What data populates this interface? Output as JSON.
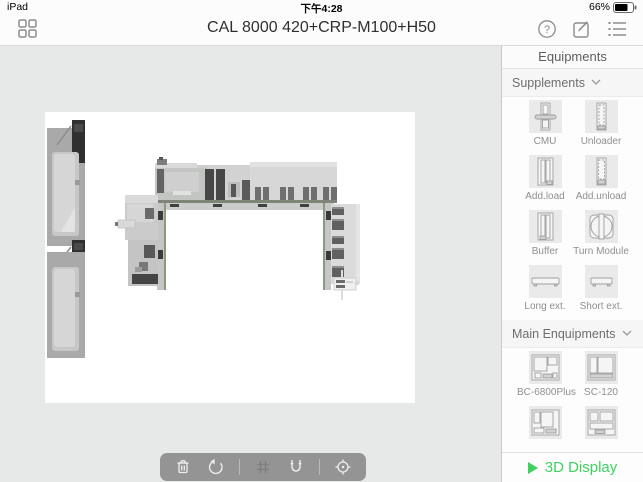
{
  "status_bar": {
    "device": "iPad",
    "time": "下午4:28",
    "battery": "66%"
  },
  "nav_bar": {
    "title": "CAL 8000 420+CRP-M100+H50",
    "left_icon": "grid-apps",
    "right_icons": [
      "help",
      "compose",
      "list"
    ]
  },
  "sidebar": {
    "title": "Equipments",
    "sections": [
      {
        "label": "Supplements",
        "items": [
          {
            "label": "CMU"
          },
          {
            "label": "Unloader"
          },
          {
            "label": "Add.load"
          },
          {
            "label": "Add.unload"
          },
          {
            "label": "Buffer"
          },
          {
            "label": "Turn Module"
          },
          {
            "label": "Long ext."
          },
          {
            "label": "Short ext."
          }
        ]
      },
      {
        "label": "Main Enquipments",
        "items": [
          {
            "label": "BC-6800Plus"
          },
          {
            "label": "SC-120"
          },
          {
            "label": ""
          },
          {
            "label": ""
          }
        ]
      }
    ],
    "footer": {
      "label": "3D Display"
    }
  },
  "toolbar": {
    "icons": [
      "trash",
      "rotate-ccw",
      "snap-grid",
      "magnet",
      "locate"
    ]
  },
  "colors": {
    "accent_green": "#3ed15f",
    "content_bg": "#e7e8e8",
    "canvas_bg": "#ffffff"
  }
}
